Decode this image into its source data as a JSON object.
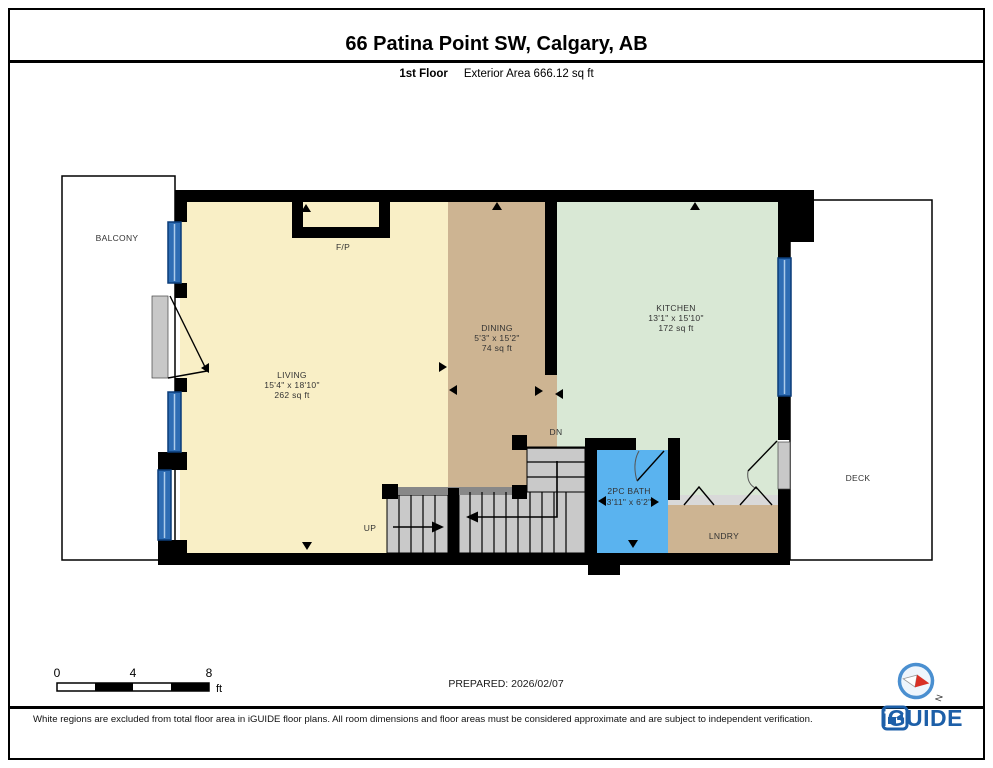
{
  "page": {
    "title": "66 Patina Point SW, Calgary, AB",
    "floor_label": "1st Floor",
    "area_label": "Exterior Area 666.12 sq ft",
    "prepared": "PREPARED: 2026/02/07"
  },
  "rooms": {
    "living": {
      "name": "LIVING",
      "dims": "15'4\" x 18'10\"",
      "area": "262 sq ft"
    },
    "dining": {
      "name": "DINING",
      "dims": "5'3\" x 15'2\"",
      "area": "74 sq ft"
    },
    "kitchen": {
      "name": "KITCHEN",
      "dims": "13'1\" x 15'10\"",
      "area": "172 sq ft"
    },
    "bath": {
      "name": "2PC BATH",
      "dims": "3'11\" x 6'2\""
    },
    "laundry": {
      "name": "LNDRY"
    },
    "balcony": {
      "name": "BALCONY"
    },
    "deck": {
      "name": "DECK"
    }
  },
  "annotations": {
    "up": "UP",
    "down": "DN",
    "fireplace": "F/P"
  },
  "scale_bar": {
    "tick0": "0",
    "tick1": "4",
    "tick2": "8",
    "unit": "ft"
  },
  "compass": {
    "north": "N"
  },
  "footer": {
    "disclaimer": "White regions are excluded from total floor area in iGUIDE floor plans. All room dimensions and floor areas must be considered approximate and are subject to independent verification.",
    "brand": "iGUIDE"
  },
  "colors": {
    "living": "#F9EFC6",
    "dining": "#CDB492",
    "kitchen": "#D9E8D5",
    "bath": "#5AB3EF",
    "stairs": "#C9C9C9",
    "window": "#2E6DB4",
    "wall": "#000000",
    "brand_blue": "#1D5FA8"
  }
}
